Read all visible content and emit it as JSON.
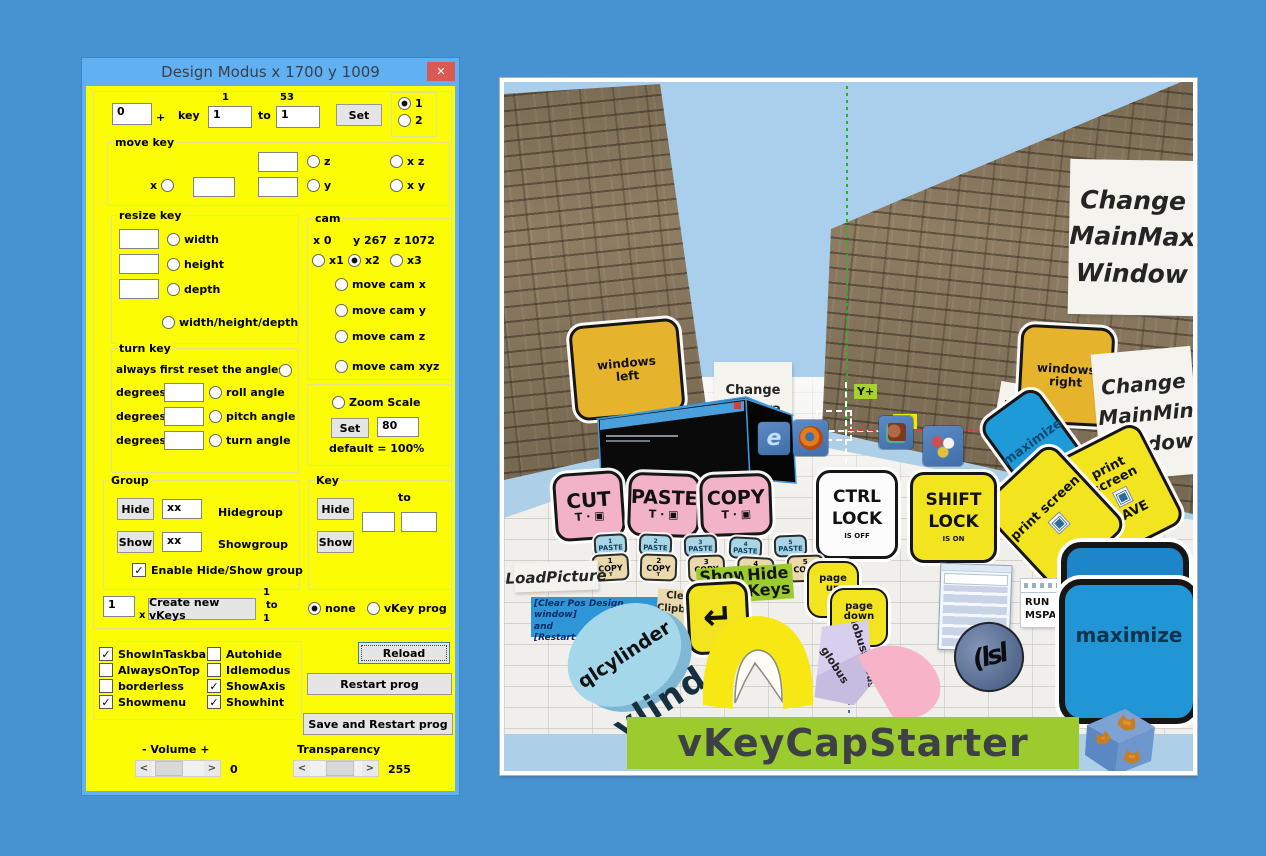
{
  "glyphs": {
    "check": "✓",
    "scroll_left": "<",
    "scroll_right": ">",
    "close": "✕"
  },
  "window": {
    "title": "Design Modus  x 1700 y 1009"
  },
  "panel": {
    "top": {
      "offset": "0",
      "plus": "+",
      "key_label": "key",
      "from_hint": "1",
      "from_value": "1",
      "to_label": "to",
      "to_hint": "53",
      "to_value": "1",
      "set": "Set",
      "r1": "1",
      "r2": "2"
    },
    "move_key": {
      "title": "move key",
      "x": "x",
      "z": "z",
      "y": "y",
      "xz": "x z",
      "xy": "x y"
    },
    "resize_key": {
      "title": "resize key",
      "width": "width",
      "height": "height",
      "depth": "depth",
      "whd": "width/height/depth"
    },
    "turn_key": {
      "title": "turn key",
      "reset": "always first reset the angles",
      "degrees": "degrees",
      "roll": "roll angle",
      "pitch": "pitch angle",
      "turn": "turn angle"
    },
    "cam": {
      "title": "cam",
      "x": "x 0",
      "y": "y 267",
      "z": "z 1072",
      "x1": "x1",
      "x2": "x2",
      "x3": "x3",
      "mcx": "move cam x",
      "mcy": "move cam y",
      "mcz": "move cam z",
      "mcxyz": "move cam xyz"
    },
    "zoom": {
      "label": "Zoom Scale",
      "set": "Set",
      "value": "80",
      "default": "default = 100%"
    },
    "group": {
      "title": "Group",
      "hide": "Hide",
      "show": "Show",
      "hide_value": "xx",
      "show_value": "xx",
      "hidegroup": "Hidegroup",
      "showgroup": "Showgroup",
      "enable": "Enable Hide/Show group"
    },
    "key": {
      "title": "Key",
      "hide": "Hide",
      "show": "Show",
      "to": "to"
    },
    "create": {
      "count": "1",
      "x": "x",
      "button": "Create new vKeys",
      "from": "1",
      "to": "to",
      "to_value": "1",
      "none": "none",
      "prog": "vKey prog"
    },
    "options": {
      "col1": [
        {
          "label": "ShowInTaskbar",
          "checked": true
        },
        {
          "label": "AlwaysOnTop",
          "checked": false
        },
        {
          "label": "borderless",
          "checked": false
        },
        {
          "label": "Showmenu",
          "checked": true
        }
      ],
      "col2": [
        {
          "label": "Autohide",
          "checked": false
        },
        {
          "label": "Idlemodus",
          "checked": false
        },
        {
          "label": "ShowAxis",
          "checked": true
        },
        {
          "label": "Showhint",
          "checked": true
        }
      ]
    },
    "buttons": {
      "reload": "Reload",
      "restart": "Restart prog",
      "save_restart": "Save and Restart prog"
    },
    "volume": {
      "label": "- Volume +",
      "value": "0"
    },
    "transparency": {
      "label": "Transparency",
      "value": "255"
    }
  },
  "scene": {
    "axis": {
      "y_label": "Y+",
      "x_label": "X+"
    },
    "signs": {
      "windows_left": "windows\nleft",
      "change_camera": "Change\nCamera\nPosition",
      "restart_prog": "RESTART\nPROG",
      "change_mainmax": "Change\nMainMax\nWindow",
      "windows_right": "windows\nright",
      "change_mainmin": "Change\nMainMin\nWindow",
      "load_picture": "LoadPicture",
      "clear_pos": "[Clear Pos Design window]\nand\n[Restart prog]",
      "clear_clipboard": "Clear\nClipboard",
      "show_keys": "Show\nKeys",
      "hide_keys": "Hide\nKeys",
      "run_mspaint": "RUN\nMSPAINT"
    },
    "keys": {
      "cut": {
        "label": "CUT",
        "sub": "T · ▣"
      },
      "paste": {
        "label": "PASTE",
        "sub": "T · ▣"
      },
      "copy": {
        "label": "COPY",
        "sub": "T · ▣"
      },
      "ctrl_lock": {
        "line1": "CTRL",
        "line2": "LOCK",
        "status": "IS OFF"
      },
      "shift_lock": {
        "line1": "SHIFT",
        "line2": "LOCK",
        "status": "IS ON"
      },
      "enter": "↵",
      "page_up": "page\nup\n^",
      "page_down": "page\ndown\nv",
      "maximize_side": "maximize",
      "print_screen_save": {
        "line1": "print screen",
        "icon": "▣",
        "line2": "SAVE"
      },
      "print_screen": {
        "line1": "print screen",
        "icon": "▣"
      },
      "minimize_big": "minimize",
      "maximize_big": "maximize",
      "globus": "globus",
      "cylinder": "qlcylinder",
      "cylinder_shadow": "ylind",
      "sphere": "(lsl"
    },
    "paste_row": [
      {
        "n": "1",
        "t": "PASTE"
      },
      {
        "n": "2",
        "t": "PASTE"
      },
      {
        "n": "3",
        "t": "PASTE"
      },
      {
        "n": "4",
        "t": "PASTE"
      },
      {
        "n": "5",
        "t": "PASTE"
      }
    ],
    "copy_row": [
      {
        "n": "1",
        "t": "COPY",
        "s": "T"
      },
      {
        "n": "2",
        "t": "COPY",
        "s": "T"
      },
      {
        "n": "3",
        "t": "COPY",
        "s": "T"
      },
      {
        "n": "4",
        "t": "COPY",
        "s": "T"
      },
      {
        "n": "5",
        "t": "COPY",
        "s": "T"
      }
    ],
    "banner": "vKeyCapStarter"
  },
  "colors": {
    "desktop": "#4793d2",
    "panel": "#fcfc04",
    "titlebar": "#60b0f2",
    "close": "#d95a52",
    "sky": "#a9cfed",
    "banner_green": "#9ccb2d",
    "key_pink": "#f2b2c8",
    "key_yellow": "#f2e41f",
    "key_blue": "#1e9ad8",
    "key_orange": "#e6b32c",
    "water": "#aecfe8"
  }
}
